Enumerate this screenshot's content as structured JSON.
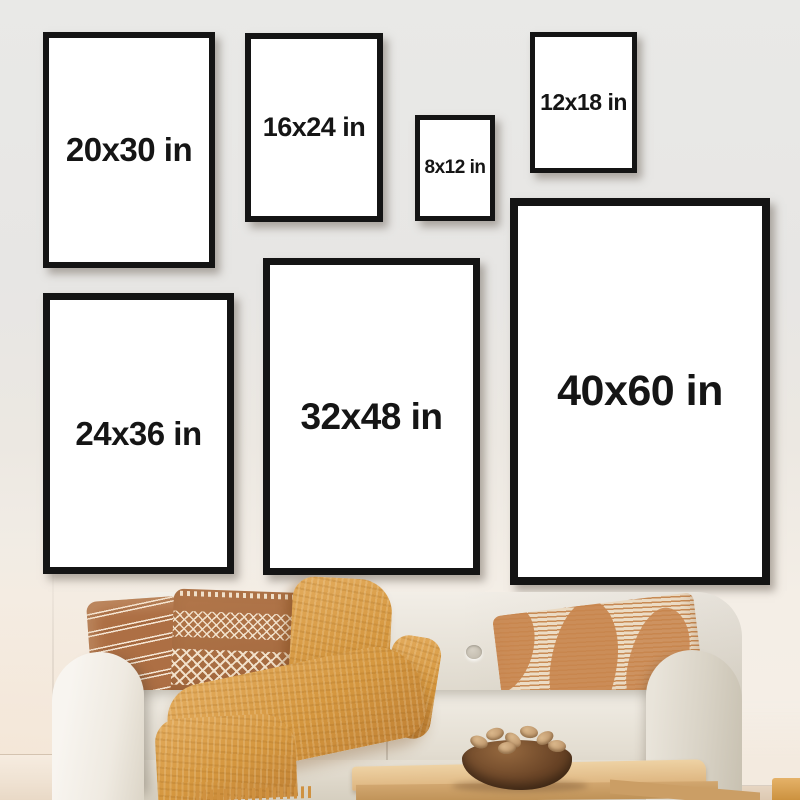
{
  "posters": {
    "items": [
      {
        "label": "20x30 in"
      },
      {
        "label": "16x24 in"
      },
      {
        "label": "8x12 in"
      },
      {
        "label": "12x18 in"
      },
      {
        "label": "24x36 in"
      },
      {
        "label": "32x48 in"
      },
      {
        "label": "40x60 in"
      }
    ]
  },
  "colors": {
    "wall_top": "#e9e9e7",
    "wall_bottom": "#f6efe7",
    "frame_border": "#141414",
    "frame_fill": "#ffffff",
    "label_text": "#151515",
    "sofa_fabric": "#e6e0d6",
    "pillow_brown": "#ab6f45",
    "pillow_pattern_cream": "#f0e0ca",
    "pillow_stripe_orange": "#c8854e",
    "blanket_mustard": "#d5973f",
    "table_wood": "#ddb47e",
    "bowl_wood": "#6b4527",
    "floor": "#e6d5c2"
  }
}
